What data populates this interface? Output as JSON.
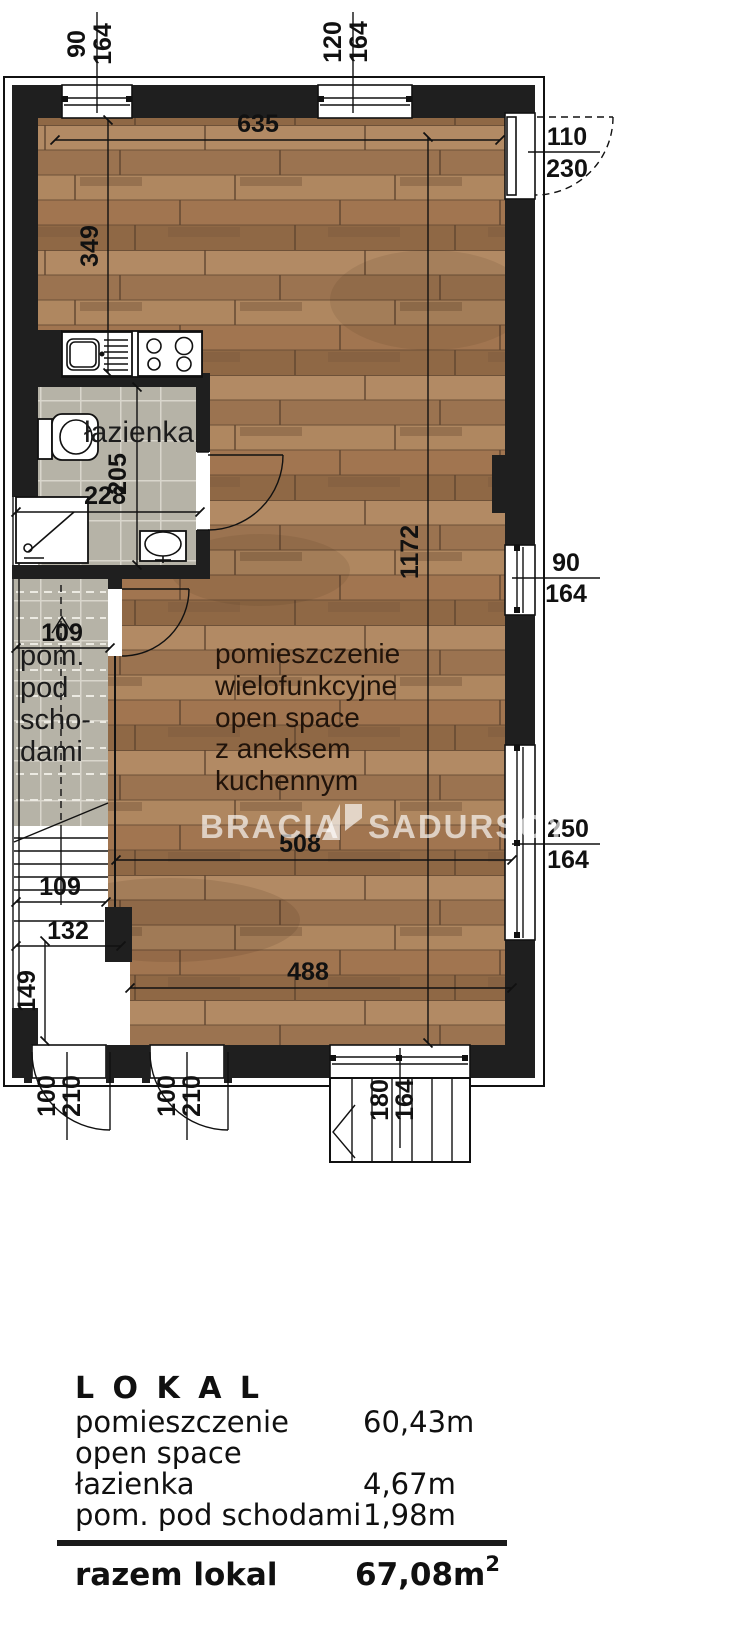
{
  "plan": {
    "labels": {
      "bathroom": "łazienka",
      "understairs": [
        "pom.",
        "pod",
        "scho-",
        "dami"
      ],
      "main_room": [
        "pomieszczenie",
        "wielofunkcyjne",
        "open space",
        "z aneksem",
        "kuchennym"
      ]
    },
    "dims": {
      "win_top_1": {
        "num": "90",
        "den": "164"
      },
      "win_top_2": {
        "num": "120",
        "den": "164"
      },
      "door_entry": {
        "num": "110",
        "den": "230"
      },
      "width_top": "635",
      "kitchen_depth": "349",
      "bath_width": "228",
      "bath_depth": "205",
      "room_length": "1172",
      "win_right_1": {
        "num": "90",
        "den": "164"
      },
      "win_right_2": {
        "num": "250",
        "den": "164"
      },
      "understairs_width": "109",
      "stairs_width": "109",
      "hall_width": "132",
      "hall_depth": "149",
      "width_mid": "508",
      "width_bottom": "488",
      "door_bottom_1": {
        "num": "100",
        "den": "210"
      },
      "door_bottom_2": {
        "num": "100",
        "den": "210"
      },
      "win_bottom": {
        "num": "180",
        "den": "164"
      }
    },
    "fixtures": [
      "kitchen-sink-icon",
      "stove-icon",
      "toilet-icon",
      "shower-icon",
      "washbasin-icon",
      "interior-stairs-icon",
      "exterior-stairs-icon"
    ],
    "colors": {
      "wall": "#1f1f1f",
      "tile": "#b6b3a7",
      "wood": "#a57a57",
      "watermark": "#ffffff",
      "line": "#111111"
    }
  },
  "watermark": {
    "left": "BRACIA",
    "right": "SADURSCY"
  },
  "table": {
    "title": "L O K A L",
    "rows": [
      {
        "label_lines": [
          "pomieszczenie",
          "open space"
        ],
        "value": "60,43m"
      },
      {
        "label_lines": [
          "łazienka"
        ],
        "value": "4,67m"
      },
      {
        "label_lines": [
          "pom. pod schodami"
        ],
        "value": "1,98m"
      }
    ],
    "total_label": "razem lokal",
    "total_value": "67,08m",
    "total_sup": "2"
  }
}
